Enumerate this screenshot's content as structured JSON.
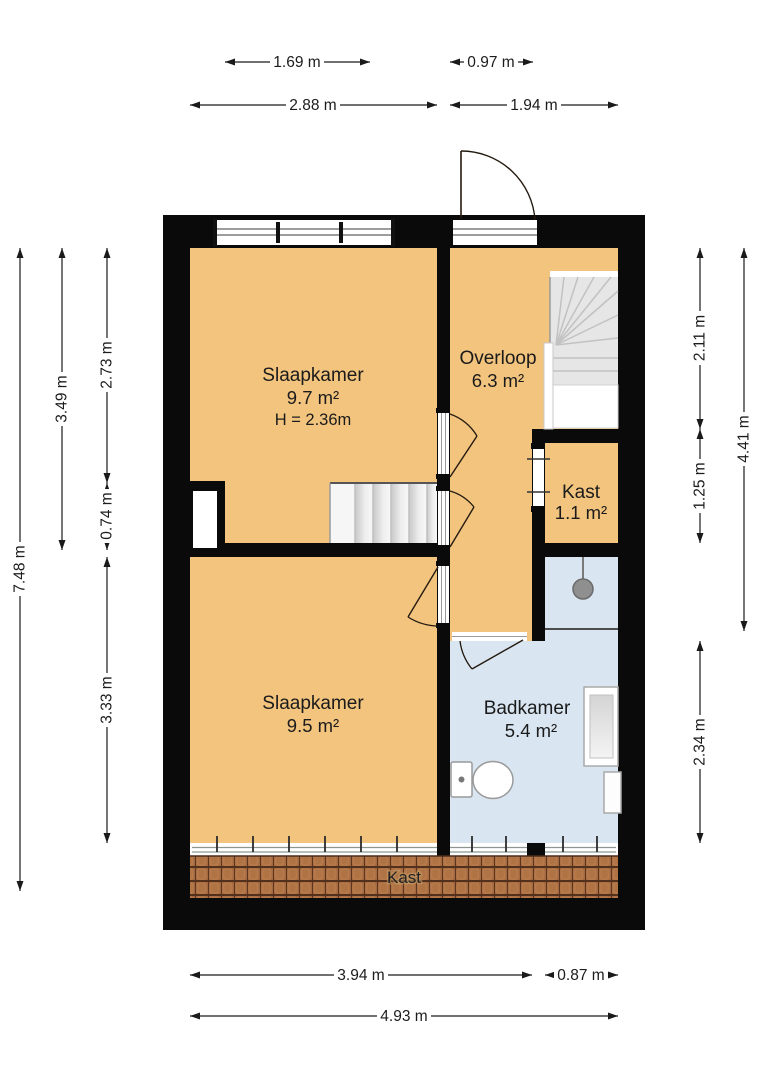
{
  "rooms": {
    "bedroom_top": {
      "name": "Slaapkamer",
      "area": "9.7 m²",
      "ceiling_height": "H = 2.36m"
    },
    "landing": {
      "name": "Overloop",
      "area": "6.3 m²"
    },
    "closet": {
      "name": "Kast",
      "area": "1.1 m²"
    },
    "bedroom_bottom": {
      "name": "Slaapkamer",
      "area": "9.5 m²"
    },
    "bathroom": {
      "name": "Badkamer",
      "area": "5.4 m²"
    },
    "eaves_storage": {
      "name": "Kast"
    }
  },
  "dimensions": {
    "top_row1": [
      "1.69 m",
      "0.97 m"
    ],
    "top_row2": [
      "2.88 m",
      "1.94 m"
    ],
    "left_col1": [
      "7.48 m"
    ],
    "left_col2": [
      "3.49 m"
    ],
    "left_col3": [
      "2.73 m",
      "0.74 m",
      "3.33 m"
    ],
    "right_col1": [
      "2.11 m",
      "1.25 m",
      "2.34 m"
    ],
    "right_col2": [
      "4.41 m"
    ],
    "bottom_row1": [
      "3.94 m",
      "0.87 m"
    ],
    "bottom_row2": [
      "4.93 m"
    ]
  },
  "colors": {
    "room_floor": "#F2C47E",
    "bathroom_floor": "#D9E6F2",
    "wall": "#0A0A0A",
    "stairs": "#E6E6E6",
    "roof_tiles": "#A5693F",
    "dimension_text": "#1C1C1C",
    "background": "#FFFFFF"
  }
}
